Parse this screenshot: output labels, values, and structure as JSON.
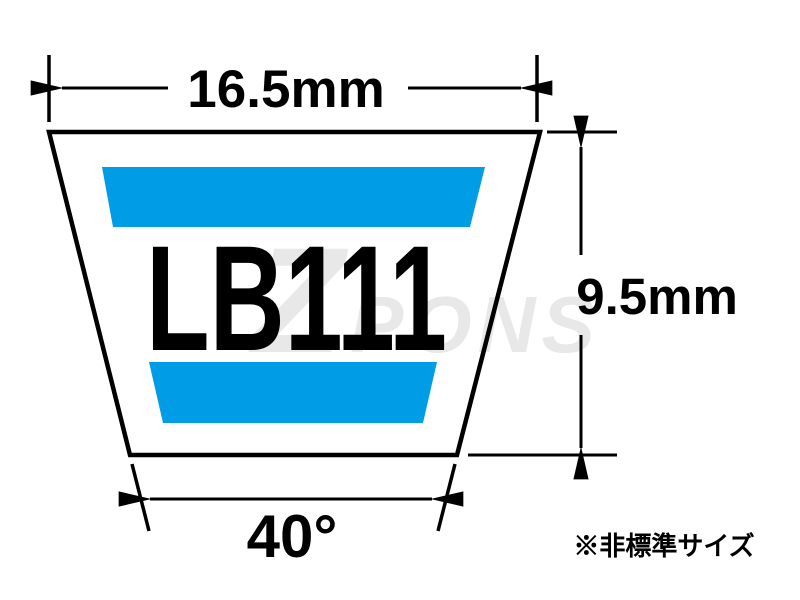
{
  "diagram": {
    "part_number": "LB111",
    "dimensions": {
      "top_width": "16.5mm",
      "height": "9.5mm",
      "angle": "40°"
    },
    "footnote": "※非標準サイズ",
    "watermark": {
      "prefix": "Z",
      "text": "PONS"
    },
    "colors": {
      "stripe_blue": "#009DE6",
      "outline_black": "#000000",
      "watermark_gray": "#E8E8E8",
      "background": "#FFFFFF"
    }
  }
}
